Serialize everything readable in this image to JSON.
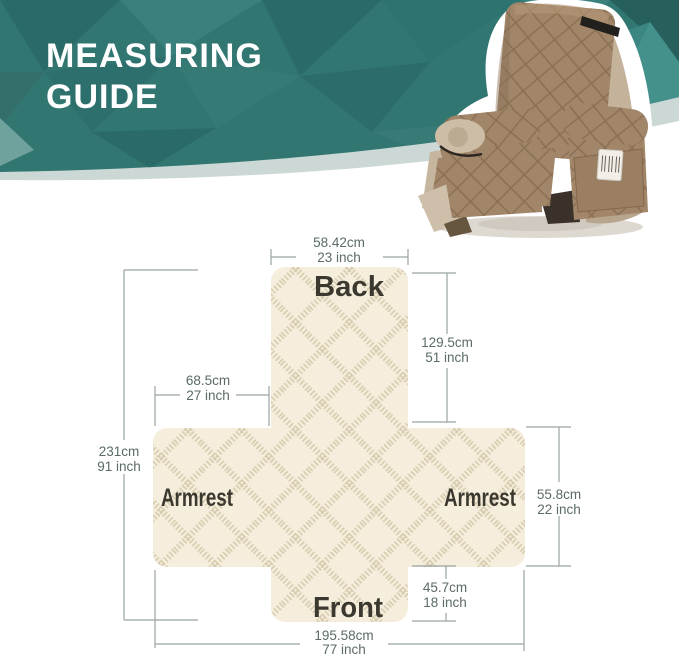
{
  "header": {
    "title_line1": "MEASURING",
    "title_line2": "GUIDE",
    "band_color": "#327672",
    "stripe_color": "#ccd8d5"
  },
  "photo": {
    "alt": "recliner chair with quilted slipcover",
    "cover_color": "#a1866a",
    "frame_color": "#c4b29b"
  },
  "diagram": {
    "fabric_color": "#f5eedc",
    "pattern_color": "#d5c9ac",
    "line_color": "#9aa49f",
    "measure_text_color": "#5b6b66",
    "label_color": "#3b382f",
    "labels": {
      "back": "Back",
      "front": "Front",
      "armrest_left": "Armrest",
      "armrest_right": "Armrest"
    },
    "measurements": {
      "back_width": {
        "cm": "58.42cm",
        "inch": "23 inch"
      },
      "back_height": {
        "cm": "129.5cm",
        "inch": "51 inch"
      },
      "armrest_width": {
        "cm": "68.5cm",
        "inch": "27 inch"
      },
      "total_length": {
        "cm": "231cm",
        "inch": "91 inch"
      },
      "armrest_height": {
        "cm": "55.8cm",
        "inch": "22 inch"
      },
      "front_height": {
        "cm": "45.7cm",
        "inch": "18 inch"
      },
      "total_width": {
        "cm": "195.58cm",
        "inch": "77 inch"
      }
    }
  }
}
